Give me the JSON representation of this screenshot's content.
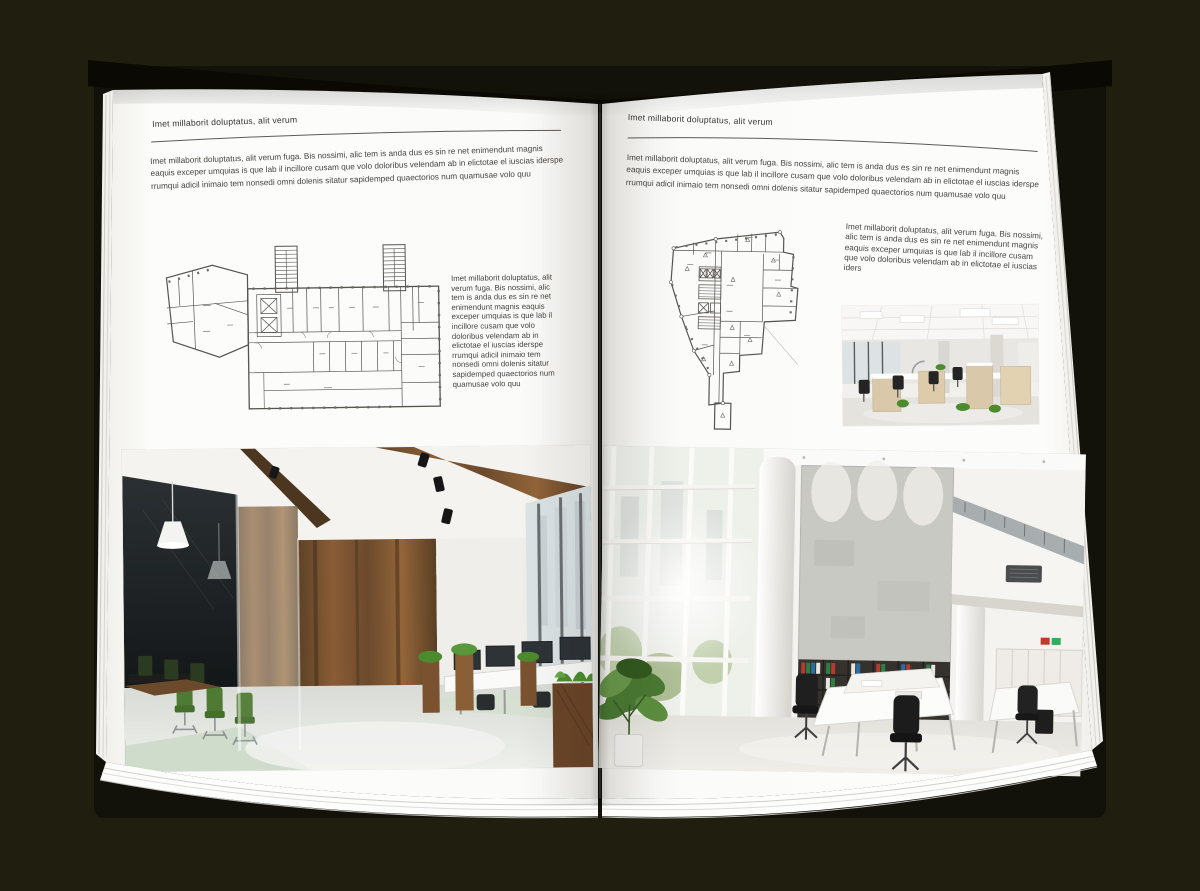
{
  "document": {
    "type": "open-brochure-mockup",
    "left_page": {
      "kicker": "Imet millaborit doluptatus, alit verum",
      "intro": "Imet millaborit doluptatus, alit verum fuga. Bis nossimi, alic tem is anda dus es sin re net enimendunt magnis eaquis exceper umquias is que lab il incillore cusam que volo doloribus velendam ab in elictotae el iuscias iderspe rrumqui adicil inimaio tem nonsedi omni dolenis sitatur sapidemped quaectorios num quamusae volo quu",
      "caption": "Imet millaborit doluptatus, alit verum fuga. Bis nossimi, alic tem is anda dus es sin re net enimendunt magnis eaquis exceper umquias is que lab il incillore cusam que volo doloribus velendam ab in elictotae el iuscias iderspe rrumqui adicil inimaio tem nonsedi omni dolenis sitatur sapidemped quaectorios num quamusae volo quu",
      "floor_plan_alt": "rectangular office floor plan with two stair towers",
      "photo_alt": "loft office: dark glass meeting room, green chairs, wood walls"
    },
    "right_page": {
      "kicker": "Imet millaborit doluptatus, alit verum",
      "intro": "Imet millaborit doluptatus, alit verum fuga. Bis nossimi, alic tem is anda dus es sin re net enimendunt magnis eaquis exceper umquias is que lab il incillore cusam que volo doloribus velendam ab in elictotae el iuscias iderspe rrumqui adicil inimaio tem nonsedi omni dolenis sitatur sapidemped quaectorios num quamusae volo quu",
      "caption": "Imet millaborit doluptatus, alit verum fuga. Bis nossimi, alic tem is anda dus es sin re net enimendunt magnis eaquis exceper umquias is que lab il incillore cusam que volo doloribus velendam ab in elictotae el iuscias iders",
      "floor_plan_alt": "irregular triangular office floor plan",
      "photo_small_alt": "bright open-plan office with desk rows",
      "photo_alt": "white double-height atrium office with window wall and binder shelves"
    },
    "colors": {
      "background": "#201e0f",
      "page": "#fbfbf9",
      "text": "#45443f",
      "plan_lines": "#4f4f4c",
      "wood": "#7a5230",
      "chair_green": "#4e7a33",
      "binders": [
        "#b23b2e",
        "#2d7f43",
        "#2b6ea5",
        "#e8e6e0",
        "#1f1f1f"
      ]
    }
  }
}
